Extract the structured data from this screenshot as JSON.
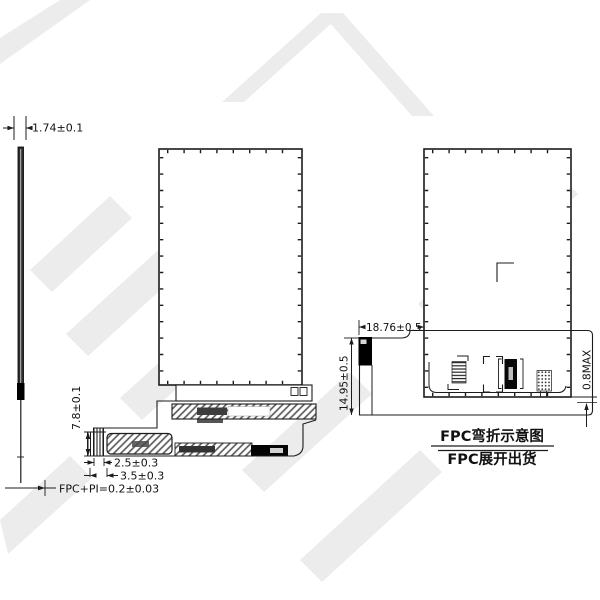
{
  "drawing": {
    "side_view": {
      "thickness_dim": "1.74±0.1",
      "fpc_pi_dim": "FPC+PI=0.2±0.03"
    },
    "front_view": {
      "fpc_area_height_dim": "7.8±0.1",
      "fold_width_dim": "2.5±0.3",
      "fold_pitch_dim": "3.5±0.3"
    },
    "bend_view": {
      "connector_offset_dim": "18.76±0.5",
      "fpc_height_dim": "14.95±0.5",
      "bend_thickness_dim": "0.8MAX",
      "caption_line1": "FPC弯折示意图",
      "caption_line2": "FPC展开出货"
    },
    "colors": {
      "line": "#1c1c1c",
      "watermark": "#ececec",
      "fill_black": "#0a0a0a"
    }
  }
}
